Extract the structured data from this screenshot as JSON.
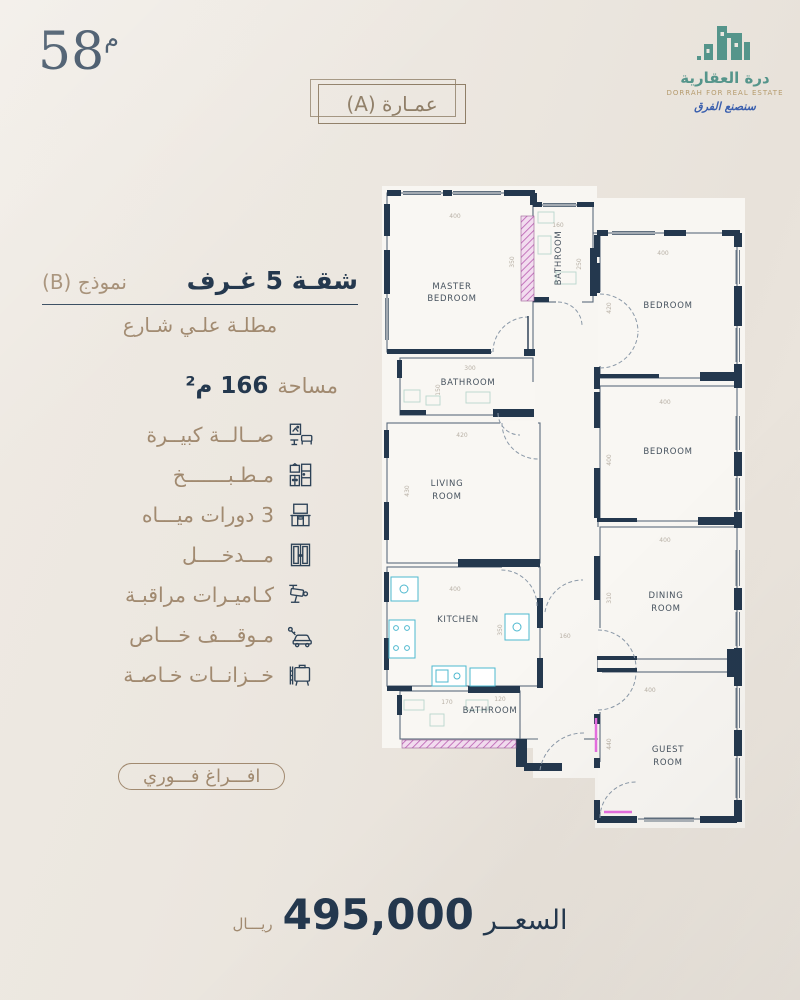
{
  "colors": {
    "navy": "#24384e",
    "tan": "#a18a70",
    "teal": "#55958b",
    "gold": "#b59b6d",
    "blue": "#3a5fae",
    "pink_hatch": "#cf7ac7",
    "magenta": "#e66ee0",
    "cyan": "#4db8cf",
    "cream": "#ece7e0"
  },
  "header": {
    "unit_number": "58",
    "unit_suffix": "م",
    "building_label": "عمـارة (A)",
    "logo": {
      "name_ar": "درة العقارية",
      "name_en": "DORRAH FOR REAL ESTATE",
      "tagline": "سنصنع الفرق"
    }
  },
  "details": {
    "apartment_type": "شقـة 5 غـرف",
    "model_label": "نموذج (B)",
    "street_view": "مطلـة علـي شـارع",
    "area_label": "مساحة",
    "area_value": "166 م²",
    "features": [
      {
        "label": "صــالــة كبيــرة",
        "icon": "living-room-icon"
      },
      {
        "label": "مـطـبـــــــخ",
        "icon": "kitchen-icon"
      },
      {
        "label": "3 دورات ميـــاه",
        "icon": "bathroom-icon"
      },
      {
        "label": "مـــدخــــل",
        "icon": "entrance-icon"
      },
      {
        "label": "كـاميـرات مراقبـة",
        "icon": "cctv-icon"
      },
      {
        "label": "مـوقـــف خـــاص",
        "icon": "parking-icon"
      },
      {
        "label": "خــزانــات خـاصـة",
        "icon": "tanks-icon"
      }
    ],
    "availability_badge": "افـــراغ فـــوري"
  },
  "price": {
    "label": "السعــر",
    "value": "495,000",
    "currency": "ريـــال"
  },
  "plan": {
    "rooms": {
      "master": [
        "MASTER",
        "BEDROOM"
      ],
      "bath_top": [
        "BATHROOM"
      ],
      "bath_mid": [
        "BATHROOM"
      ],
      "bath_bottom": [
        "BATHROOM"
      ],
      "living": [
        "LIVING",
        "ROOM"
      ],
      "kitchen": [
        "KITCHEN"
      ],
      "bed1": [
        "BEDROOM"
      ],
      "bed2": [
        "BEDROOM"
      ],
      "dining": [
        "DINING",
        "ROOM"
      ],
      "guest": [
        "GUEST",
        "ROOM"
      ]
    },
    "dims": {
      "master_w": "400",
      "master_h": "350",
      "bath_top_w": "160",
      "bath_top_h": "250",
      "bath_mid_w": "300",
      "bath_mid_h": "150",
      "living_w": "420",
      "living_h": "430",
      "kitchen_w": "400",
      "kitchen_h": "350",
      "bath_bottom_w": "170",
      "bath_bottom_w2": "120",
      "hall_w": "160",
      "bed1_w": "400",
      "bed1_h": "420",
      "bed2_w": "400",
      "bed2_h": "400",
      "dining_w": "400",
      "dining_h": "310",
      "guest_w": "400",
      "guest_h": "440"
    }
  }
}
